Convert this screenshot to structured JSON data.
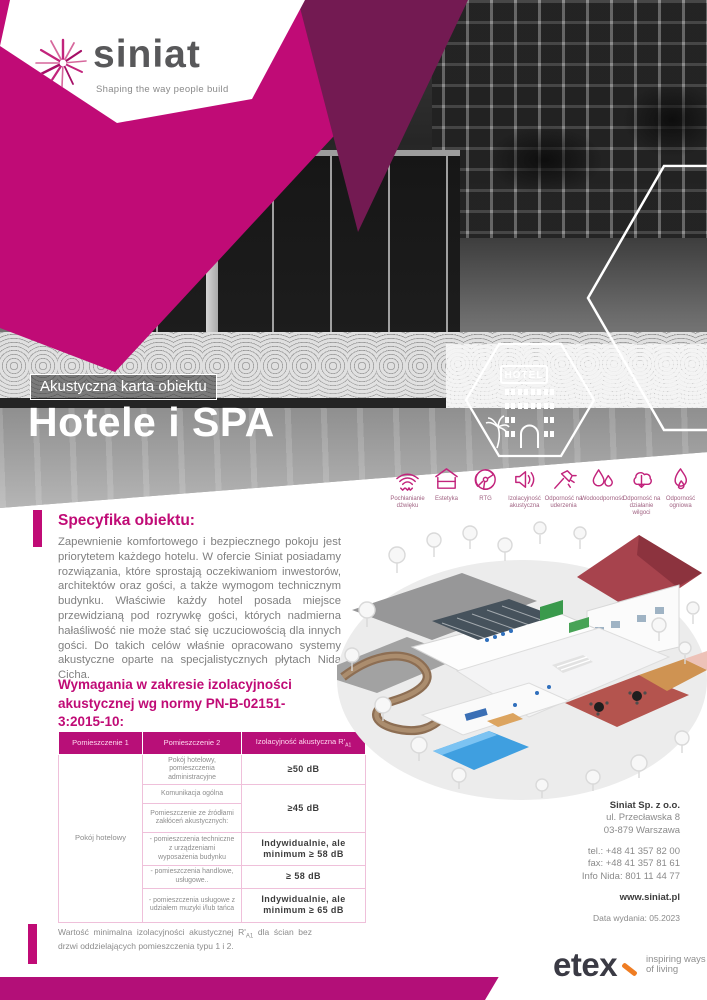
{
  "brand": {
    "logo": "siniat",
    "tagline": "Shaping the way people build",
    "colors": {
      "magenta": "#c00b76",
      "dark_purple": "#731a52",
      "footer_magenta": "#b30f78",
      "etex_orange": "#ef7d23"
    }
  },
  "hero": {
    "badge": "Akustyczna karta obiektu",
    "title": "Hotele i SPA",
    "hex_label": "HOTEL"
  },
  "features": [
    {
      "icon": "sound-absorption-icon",
      "label": "Pochłanianie dźwięku"
    },
    {
      "icon": "aesthetics-icon",
      "label": "Estetyka"
    },
    {
      "icon": "xray-icon",
      "label": "RTG"
    },
    {
      "icon": "acoustic-insulation-icon",
      "label": "Izolacyjność akustyczna"
    },
    {
      "icon": "impact-resistance-icon",
      "label": "Odporność na uderzenia"
    },
    {
      "icon": "water-resistance-icon",
      "label": "Wodoodporność"
    },
    {
      "icon": "moisture-resistance-icon",
      "label": "Odporność na działanie wilgoci"
    },
    {
      "icon": "fire-resistance-icon",
      "label": "Odporność ogniowa"
    }
  ],
  "specifics": {
    "heading": "Specyfika obiektu:",
    "body": "Zapewnienie komfortowego i bezpiecznego pokoju jest priorytetem każdego hotelu. W ofercie Siniat posiadamy rozwiązania, które sprostają oczekiwaniom inwestorów, architektów oraz gości, a także wymogom technicznym budynku. Właściwie każdy hotel posada miejsce przewidzianą pod rozrywkę gości, których nadmierna hałaśliwość nie może stać się uczuciowością dla innych gości. Do takich celów właśnie opracowano systemy akustyczne oparte na specjalistycznych płytach Nida Cicha."
  },
  "requirements": {
    "heading": "Wymagania w zakresie izolacyjności akustycznej wg normy PN-B-02151-3:2015-10:",
    "table": {
      "headers": [
        "Pomieszczenie 1",
        "Pomieszczenie 2"
      ],
      "header3_base": "Izolacyjność akustyczna R'",
      "header3_sub": "A1",
      "room1": "Pokój hotelowy",
      "rows": [
        {
          "room2": "Pokój hotelowy, pomieszczenia administracyjne",
          "value": "≥50 dB"
        },
        {
          "room2": "Komunikacja ogólna",
          "value": "≥45 dB"
        },
        {
          "room2": "Pomieszczenie ze źródłami zakłóceń akustycznych:",
          "value": ""
        },
        {
          "room2": "- pomieszczenia techniczne z urządzeniami wyposażenia budynku",
          "value": "Indywidualnie, ale minimum ≥ 58 dB"
        },
        {
          "room2": "- pomieszczenia handlowe, usługowe..",
          "value": "≥ 58 dB"
        },
        {
          "room2": "- pomieszczenia usługowe z udziałem muzyki i/lub tańca",
          "value": "Indywidualnie, ale minimum ≥ 65 dB"
        }
      ]
    },
    "footnote_base": "Wartość minimalna izolacyjności akustycznej R'",
    "footnote_sub": "A1",
    "footnote_rest": " dla ścian bez drzwi oddzielających pomieszczenia typu 1 i 2."
  },
  "contact": {
    "company": "Siniat Sp. z o.o.",
    "address_line1": "ul. Przecławska 8",
    "address_line2": "03-879 Warszawa",
    "tel": "tel.: +48 41 357 82 00",
    "fax": "fax: +48 41 357 81 61",
    "info": "Info Nida: 801 11 44 77",
    "website": "www.siniat.pl",
    "issue_date": "Data wydania: 05.2023"
  },
  "footer": {
    "logo": "etex",
    "tagline_line1": "inspiring ways",
    "tagline_line2": "of living"
  }
}
